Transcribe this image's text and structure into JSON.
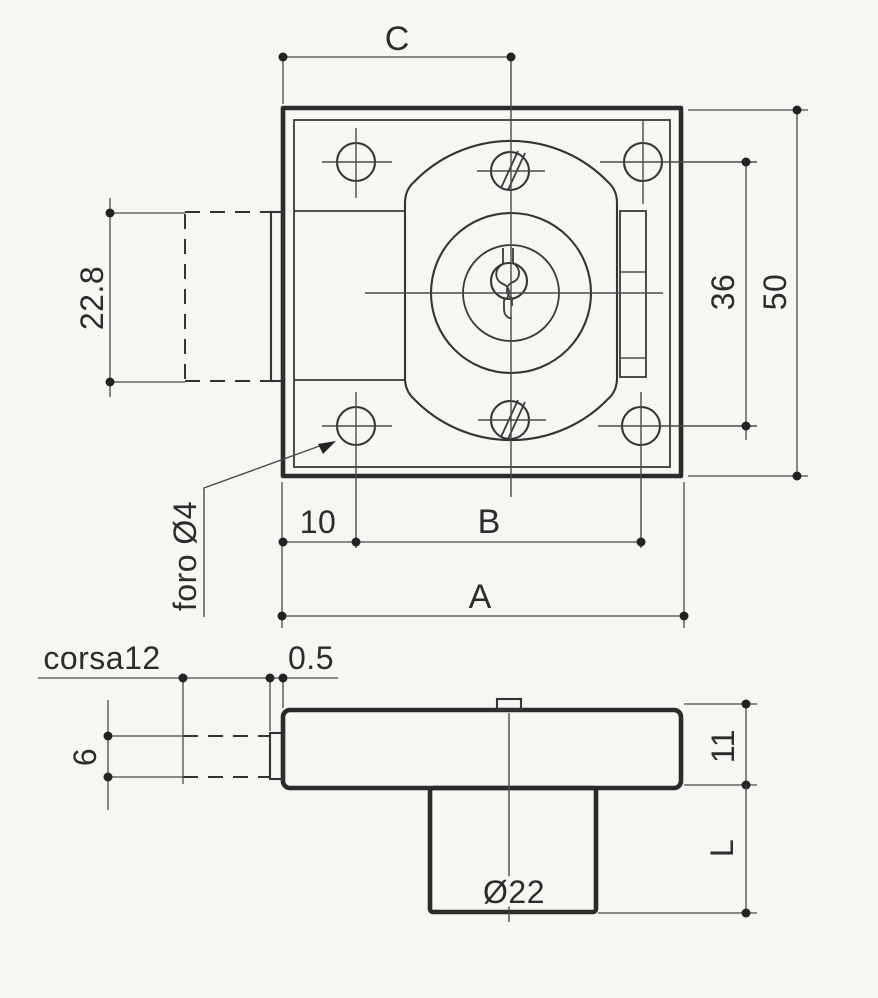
{
  "drawing": {
    "kind": "lock-technical-drawing",
    "colors": {
      "line": "#2b2b2b",
      "background": "#f7f6f3"
    },
    "front": {
      "dim_c": "C",
      "dim_latch_height": "22.8",
      "dim_hole_span": "36",
      "dim_plate": "50",
      "dim_offset": "10",
      "dim_b": "B",
      "dim_a": "A",
      "hole_callout": "foro Ø4"
    },
    "side": {
      "label_stroke": "corsa12",
      "dim_protrusion": "0.5",
      "dim_latch_thickness": "6",
      "dim_body_depth": "11",
      "dim_cylinder_length": "L",
      "dim_cylinder_diameter": "Ø22"
    }
  }
}
